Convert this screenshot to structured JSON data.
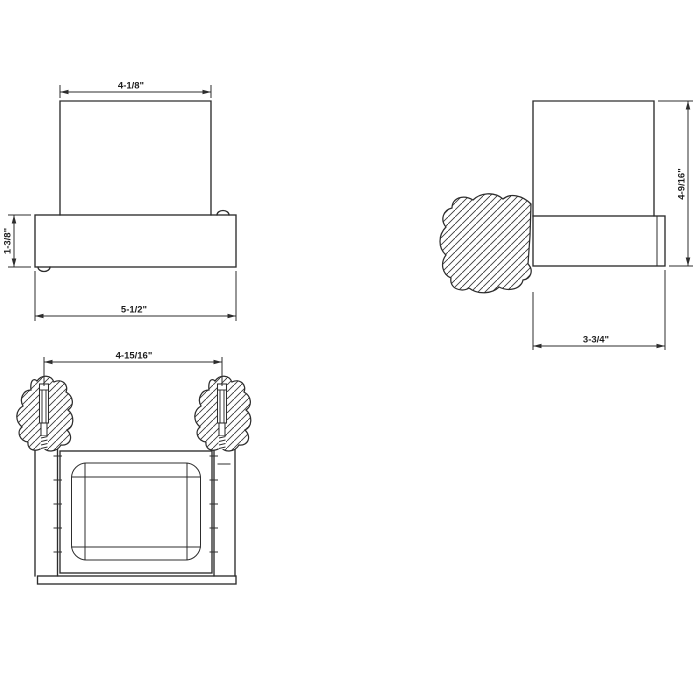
{
  "style": {
    "background": "#ffffff",
    "line_color": "#2d2d2d",
    "text_color": "#1c1c1c"
  },
  "views": {
    "front": {
      "dim_top_width": "4-1/8\"",
      "dim_base_height": "1-3/8\"",
      "dim_base_width": "5-1/2\""
    },
    "side": {
      "dim_overall_height": "4-9/16\"",
      "dim_depth": "3-3/4\""
    },
    "top": {
      "dim_anchor_spacing": "4-15/16\""
    }
  }
}
